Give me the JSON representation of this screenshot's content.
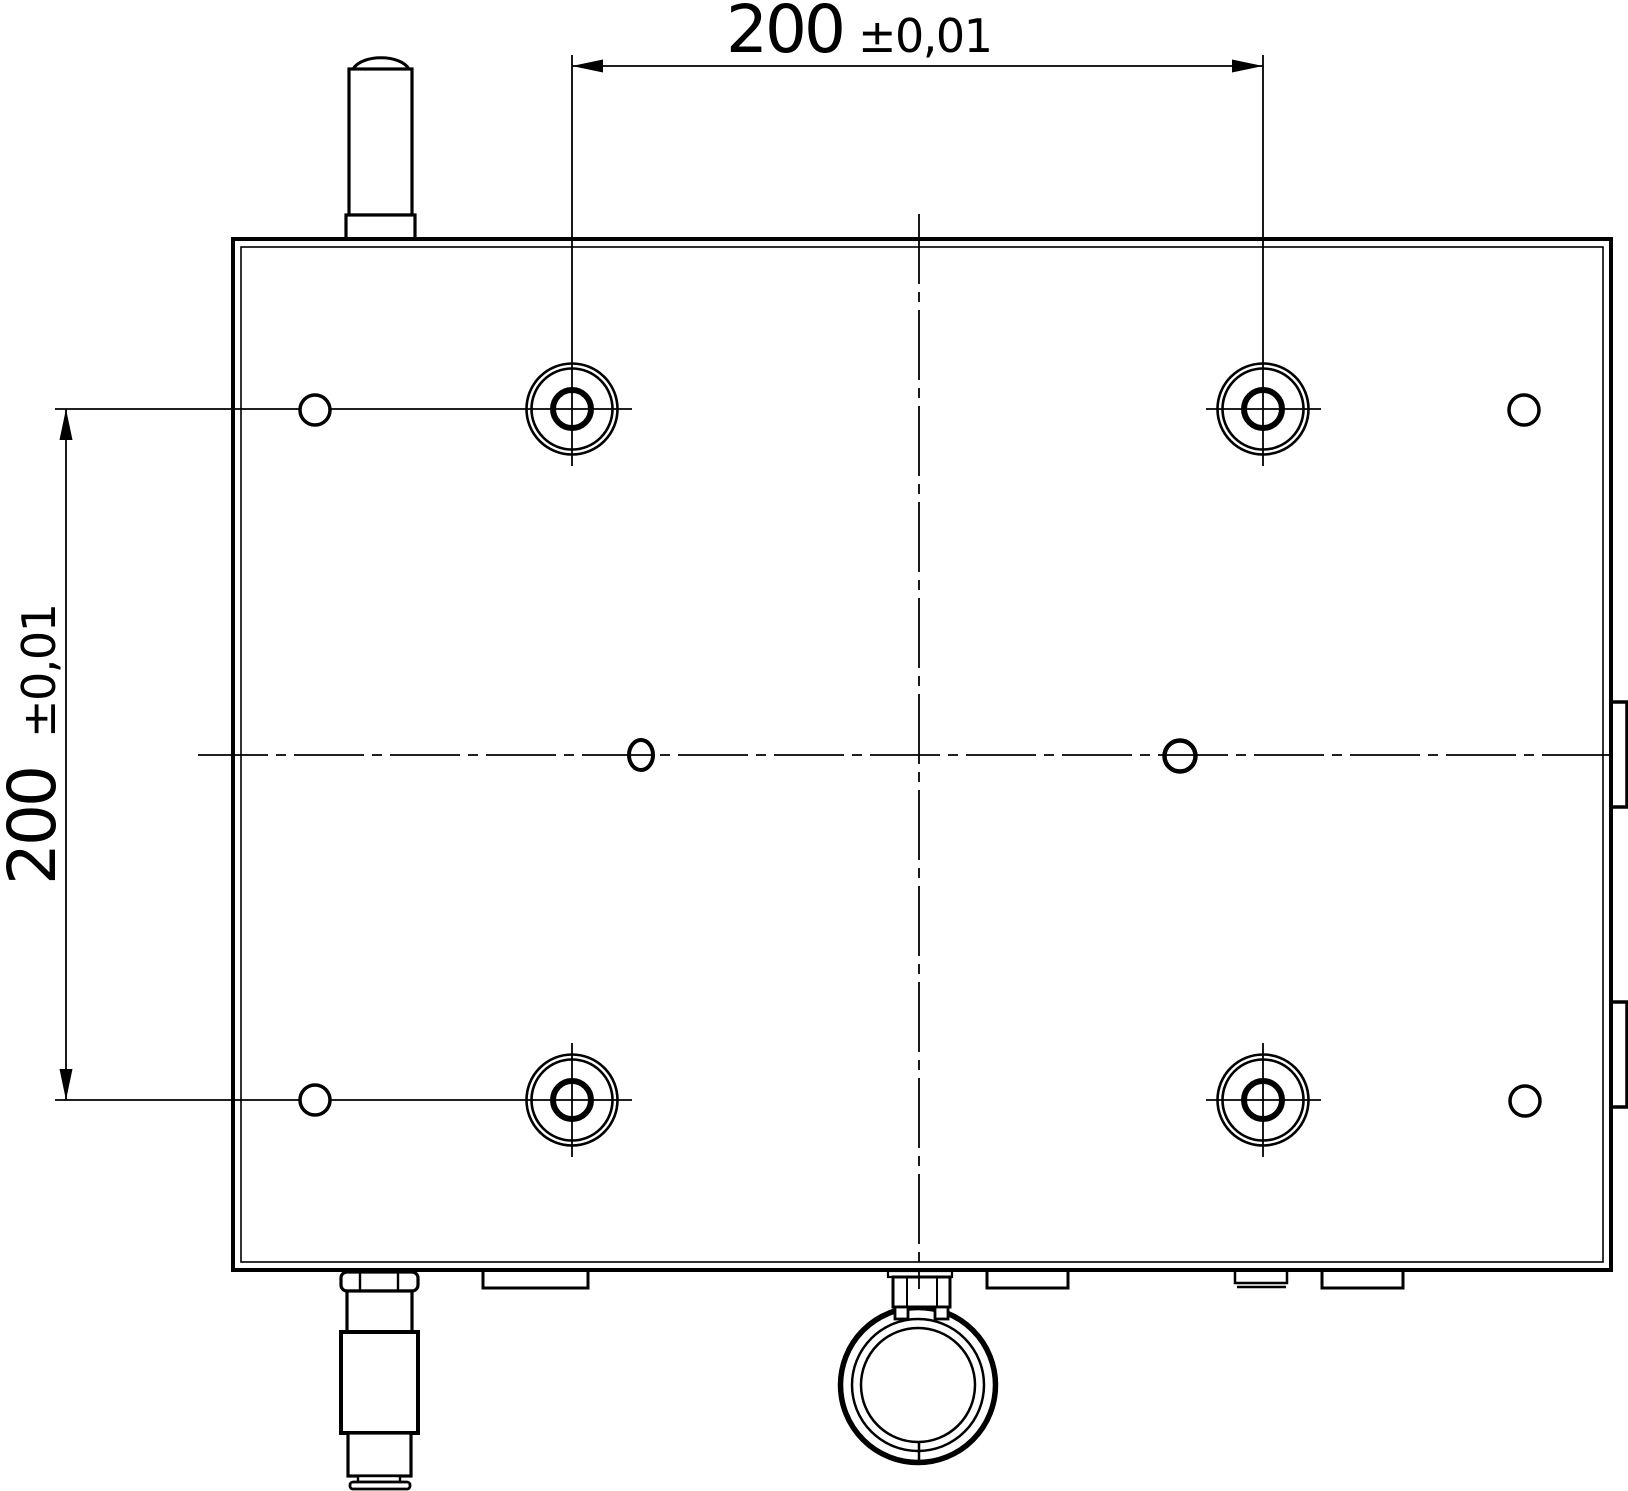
{
  "drawing": {
    "type": "engineering-drawing-top-view",
    "dimensions": {
      "horizontal": {
        "value": "200",
        "tolerance": "±0,01"
      },
      "vertical": {
        "value": "200",
        "tolerance": "±0,01"
      }
    },
    "colors": {
      "line": "#000000",
      "background": "#ffffff"
    }
  }
}
